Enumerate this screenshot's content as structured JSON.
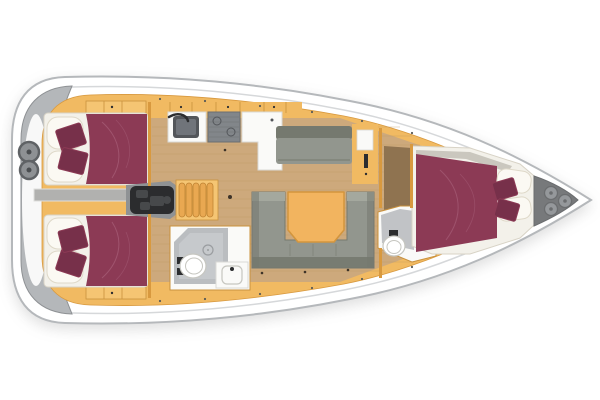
{
  "meta": {
    "type": "yacht-interior-floorplan",
    "view": "top-down",
    "orientation": "bow-right"
  },
  "counts": {
    "helm_wheels": 2,
    "bow_hatches": 3,
    "companionway_steps": 5,
    "cabins": 3,
    "wet_rooms": 2
  },
  "regions": {
    "stern_cockpit": "twin-helm cockpit",
    "aft_cabin_port": "aft double cabin",
    "aft_cabin_starboard": "aft double cabin",
    "engine_companionway": "engine bay and companionway steps",
    "galley": "galley with sink, stove and counter",
    "port_settee": "straight settee",
    "salon_settee": "U-shaped salon settee with table",
    "aft_head": "aft wet room with shower, toilet, vanity",
    "forward_head": "forward wet room with toilet and shower panel",
    "forward_cabin": "forward double cabin",
    "anchor_locker": "bow locker with deck hatches"
  },
  "colors": {
    "hull_fill": "#ffffff",
    "hull_stroke": "#b5b8bb",
    "deck_line": "#d6d8da",
    "stern_gray": "#b4b7ba",
    "stern_rim": "#8e9194",
    "wheel_ring": "#5f6265",
    "wheel_fill": "#8e9194",
    "wheel_hub": "#4a4d50",
    "cabinetry": "#f1ba62",
    "cabinetry_light": "#f5c573",
    "cabinet_line": "#c9913d",
    "wall_line": "#d8993f",
    "floor": "#cda97c",
    "floor_line": "#b8935e",
    "floor_dark": "#8f7350",
    "mattress": "#f3f1ea",
    "mattress_edge": "#d8d3c6",
    "pillow": "#fbf9f3",
    "pillow_shade": "#ded8c8",
    "bed": "#8c3a55",
    "bed_dark": "#77304a",
    "bed_seam": "#a86079",
    "settee": "#92968e",
    "settee_dark": "#75796f",
    "settee_light": "#a4a89e",
    "table": "#f2b45f",
    "table_edge": "#d3953d",
    "counter": "#fafaf8",
    "counter_edge": "#d9d9d6",
    "sink_dark": "#53565a",
    "sink_mid": "#70747a",
    "stove": "#82868a",
    "stove_line": "#6a6e71",
    "engine_dark": "#2b2c2e",
    "engine_mid": "#47494b",
    "engine_bay": "#8f9294",
    "step": "#e9a851",
    "step_edge": "#c08433",
    "corridor": "#b1b1af",
    "corridor_edge": "#dededc",
    "shower": "#babdc0",
    "shower_light": "#ced1d3",
    "shower_ring": "#9a9da0",
    "toilet_fill": "#ffffff",
    "toilet_stroke": "#c6c6c0",
    "locker": "#77797b",
    "locker_edge": "#6b6d6f",
    "hatch": "#95989b",
    "fixture_dark": "#2c2d2f",
    "deck_dot": "#5a5a55",
    "floor_dot": "#3d3328"
  }
}
